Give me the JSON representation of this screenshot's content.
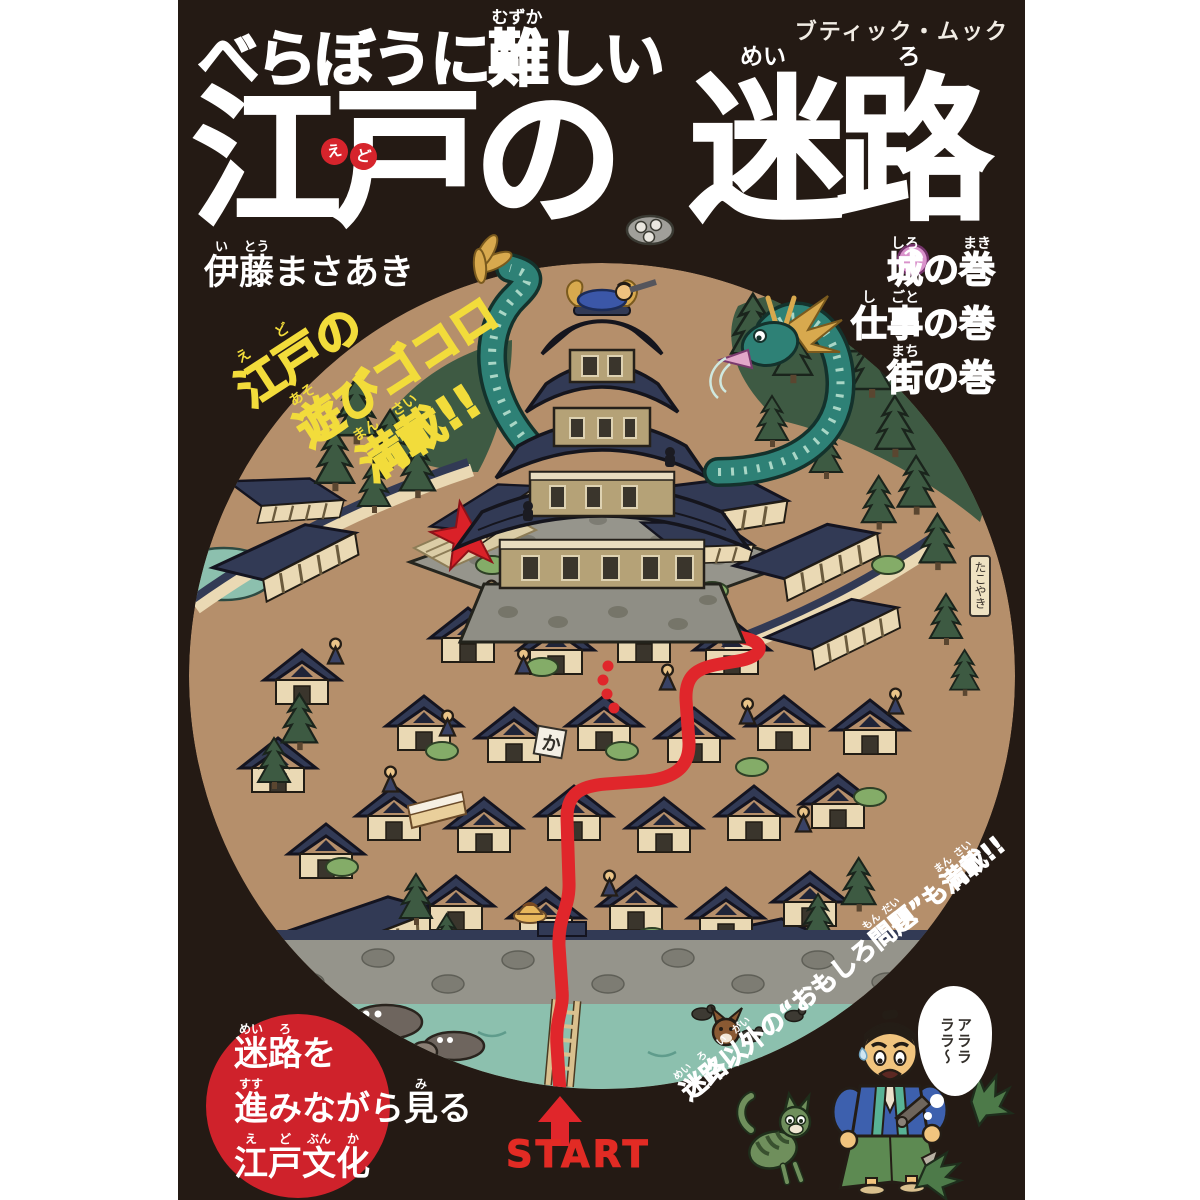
{
  "publisher": "ブティック・ムック",
  "title": {
    "line1": [
      {
        "t": "べらぼうに",
        "r": ""
      },
      {
        "t": "難",
        "r": "むずか"
      },
      {
        "t": "しい",
        "r": ""
      }
    ],
    "line2": {
      "chars": [
        "江",
        "戸",
        "の"
      ],
      "bubbles": [
        "え",
        "ど"
      ]
    },
    "line3": [
      {
        "t": "迷",
        "r": "めい"
      },
      {
        "t": "路",
        "r": "ろ"
      }
    ]
  },
  "author": [
    {
      "t": "伊",
      "r": "い"
    },
    {
      "t": "藤",
      "r": "とう"
    },
    {
      "t": "まさあき",
      "r": ""
    }
  ],
  "volumes": [
    [
      {
        "t": "城",
        "r": "しろ"
      },
      {
        "t": "の",
        "r": ""
      },
      {
        "t": "巻",
        "r": "まき"
      }
    ],
    [
      {
        "t": "仕",
        "r": "し"
      },
      {
        "t": "事",
        "r": "ごと"
      },
      {
        "t": "の巻",
        "r": ""
      }
    ],
    [
      {
        "t": "街",
        "r": "まち"
      },
      {
        "t": "の巻",
        "r": ""
      }
    ]
  ],
  "tagline": {
    "lines": [
      [
        {
          "t": "江",
          "r": "え"
        },
        {
          "t": "戸",
          "r": "ど"
        },
        {
          "t": "の",
          "r": ""
        }
      ],
      [
        {
          "t": "遊",
          "r": "あそ"
        },
        {
          "t": "びゴコロ",
          "r": ""
        }
      ],
      [
        {
          "t": "満",
          "r": "まん"
        },
        {
          "t": "載",
          "r": "さい"
        },
        {
          "t": "!!",
          "r": ""
        }
      ]
    ]
  },
  "badge": {
    "lines": [
      [
        {
          "t": "迷",
          "r": "めい"
        },
        {
          "t": "路",
          "r": "ろ"
        },
        {
          "t": "を",
          "r": ""
        }
      ],
      [
        {
          "t": "進",
          "r": "すす"
        },
        {
          "t": "みながら",
          "r": ""
        },
        {
          "t": "見",
          "r": "み"
        },
        {
          "t": "る",
          "r": ""
        }
      ],
      [
        {
          "t": "江",
          "r": "え"
        },
        {
          "t": "戸",
          "r": "ど"
        },
        {
          "t": "文",
          "r": "ぶん"
        },
        {
          "t": "化",
          "r": "か"
        }
      ]
    ]
  },
  "corner_tagline": [
    {
      "t": "迷",
      "r": "めい"
    },
    {
      "t": "路",
      "r": "ろ"
    },
    {
      "t": "以",
      "r": "い"
    },
    {
      "t": "外",
      "r": "がい"
    },
    {
      "t": "の“おもしろ",
      "r": ""
    },
    {
      "t": "問",
      "r": "もん"
    },
    {
      "t": "題",
      "r": "だい"
    },
    {
      "t": "”も",
      "r": ""
    },
    {
      "t": "満",
      "r": "まん"
    },
    {
      "t": "載",
      "r": "さい"
    },
    {
      "t": "!!",
      "r": ""
    }
  ],
  "start_label": "START",
  "speech_bubble": [
    "アララ",
    "ララ〜"
  ],
  "map_signs": {
    "roof_sign": "か",
    "shop_sign": "たこやき"
  },
  "colors": {
    "cover_bg": "#241a14",
    "accent_red": "#d6242c",
    "path_red": "#e0262b",
    "tagline_yellow": "#f2dc3b",
    "ground_tan": "#b58f6b",
    "roof_navy": "#323a55",
    "water_teal": "#8cc0ae",
    "badge_red": "#cf222b",
    "dragon_teal": "#2e8176"
  }
}
